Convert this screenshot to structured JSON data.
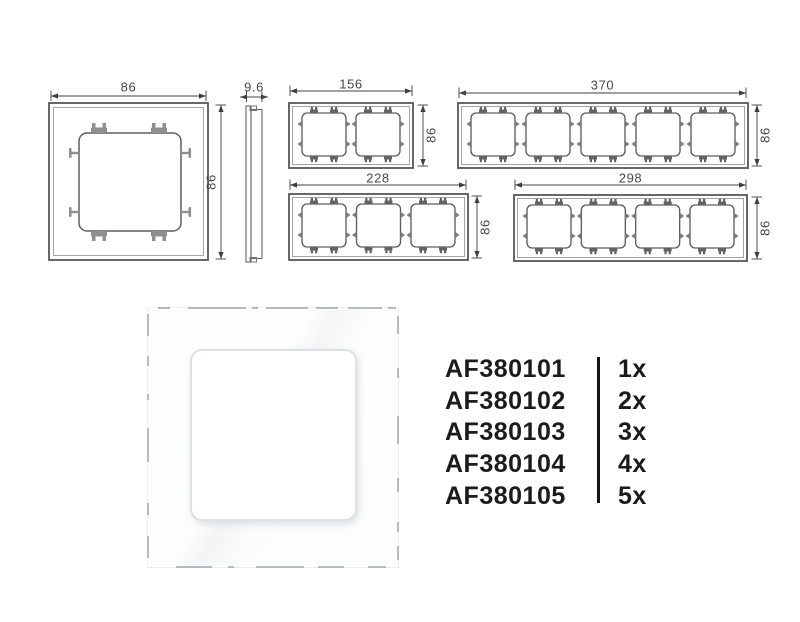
{
  "colors": {
    "background": "#ffffff",
    "drawing_line": "#585858",
    "drawing_thin_line": "#9b9b9b",
    "dimension_line": "#404040",
    "dimension_text": "#474747",
    "list_text": "#1b1b1b",
    "photo_frame": "#ffffff",
    "photo_opening_border": "#dce1e4"
  },
  "drawings": {
    "frame_1gang_back": {
      "width_mm": "86",
      "height_mm": "86"
    },
    "side_profile": {
      "depth_mm": "9.6"
    },
    "frame_2gang": {
      "width_mm": "156",
      "height_mm": "86"
    },
    "frame_3gang": {
      "width_mm": "228",
      "height_mm": "86"
    },
    "frame_4gang": {
      "width_mm": "298",
      "height_mm": "86"
    },
    "frame_5gang": {
      "width_mm": "370",
      "height_mm": "86"
    }
  },
  "product_list": {
    "items": [
      {
        "code": "AF380101",
        "qty": "1x"
      },
      {
        "code": "AF380102",
        "qty": "2x"
      },
      {
        "code": "AF380103",
        "qty": "3x"
      },
      {
        "code": "AF380104",
        "qty": "4x"
      },
      {
        "code": "AF380105",
        "qty": "5x"
      }
    ]
  }
}
